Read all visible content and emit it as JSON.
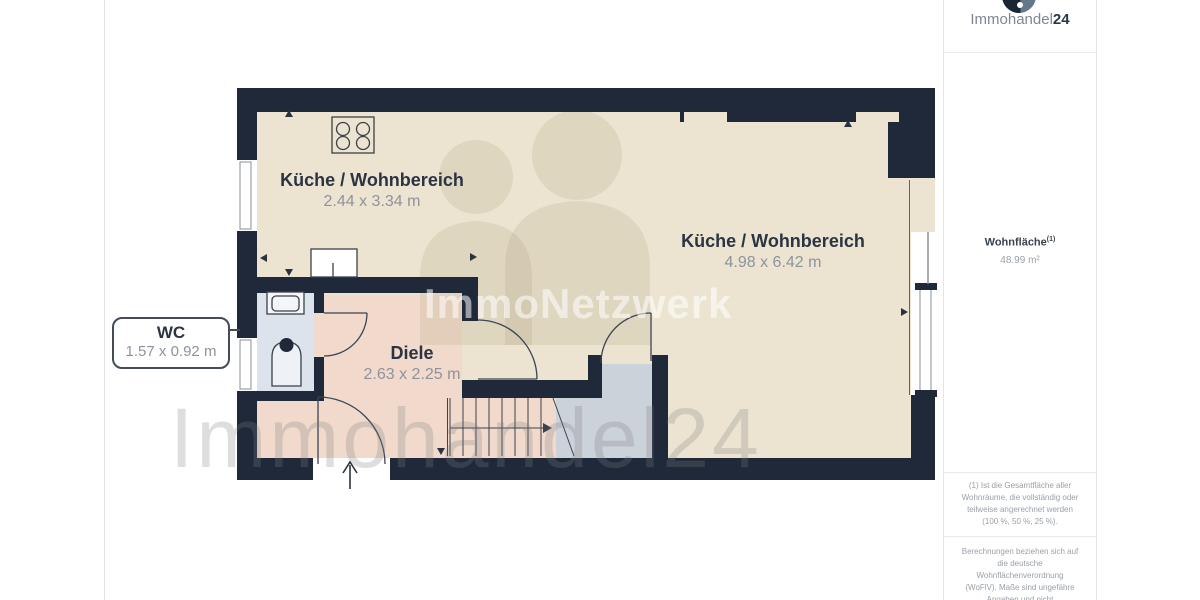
{
  "branding": {
    "logo_text": "Immohandel",
    "logo_suffix": "24",
    "watermark_center": "ImmoNetzwerk",
    "watermark_bottom": "Immohandel24"
  },
  "sidebar": {
    "area_label": "Wohnfläche",
    "area_superscript": "(1)",
    "area_value": "48.99 m²",
    "footnote_1": "(1) Ist die Gesamtfläche aller Wohnräume, die vollständig oder teilweise angerechnet werden (100 %, 50 %, 25 %).",
    "footnote_2": "Berechnungen beziehen sich auf die deutsche Wohnflächenverordnung (WoFlV). Maße sind ungefähre Angaben und nicht maßstabsgetreu. Dieser Grundriss dient nur zur"
  },
  "rooms": {
    "kitchen_small": {
      "name": "Küche / Wohnbereich",
      "dims": "2.44 x 3.34 m"
    },
    "kitchen_large": {
      "name": "Küche / Wohnbereich",
      "dims": "4.98 x 6.42 m"
    },
    "hallway": {
      "name": "Diele",
      "dims": "2.63 x 2.25 m"
    },
    "wc": {
      "name": "WC",
      "dims": "1.57 x 0.92 m"
    }
  },
  "colors": {
    "wall": "#20293a",
    "room_beige": "#ece4d1",
    "hallway_pink": "#f1d9cc",
    "wc_blue": "#dce3ec",
    "storage_gray": "#ccd2da",
    "label_text": "#2b3442",
    "dim_text": "#8d939c"
  }
}
